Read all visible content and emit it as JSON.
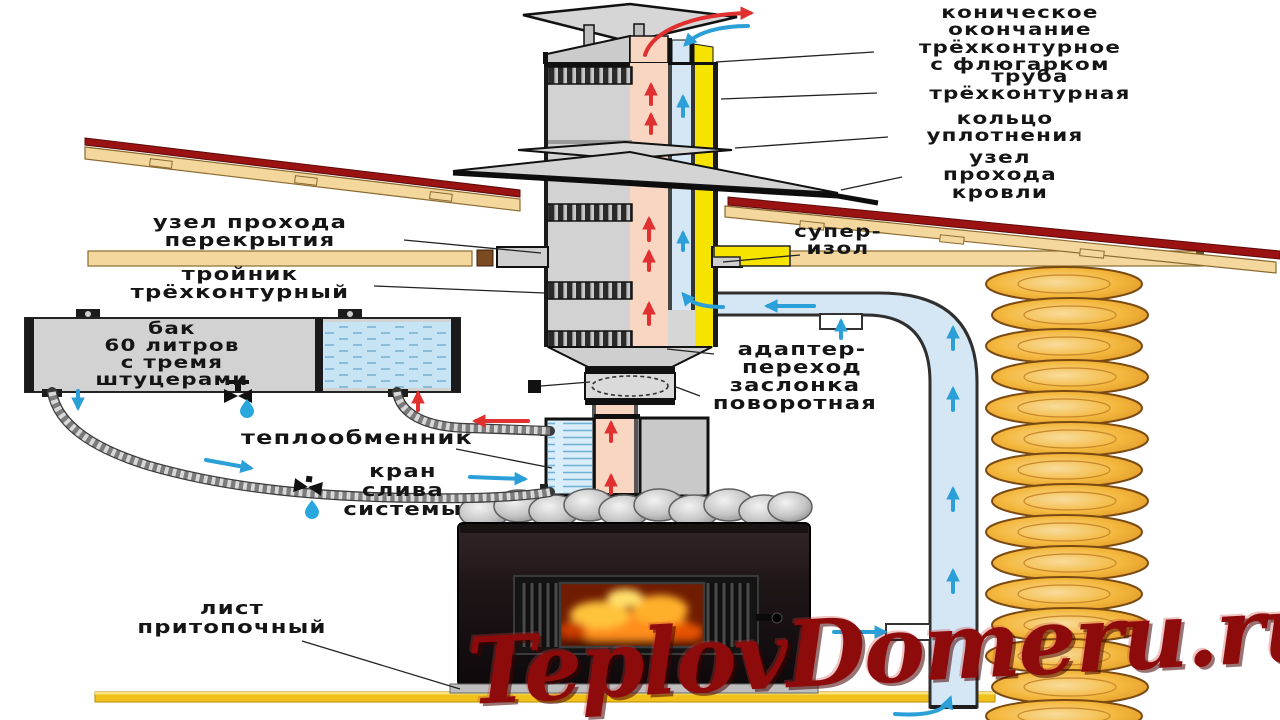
{
  "diagram": {
    "subject": "Схема монтажа банной печи с трёхконтурным дымоходом",
    "labels": {
      "cap": "коническое\nокончание\nтрёхконтурное\nс флюгарком",
      "pipe": "труба\nтрёхконтурная",
      "ring": "кольцо\nуплотнения",
      "roof_pass": "узел\nпрохода\nкровли",
      "super_isol": "супер-\nизол",
      "ceiling_pass": "узел прохода\nперекрытия",
      "tee": "тройник\nтрёхконтурный",
      "tank": "бак\n60 литров\nс тремя\nштуцерами",
      "adapter": "адаптер-\nпереход",
      "damper": "заслонка\nповоротная",
      "heat_exchanger": "теплообменник",
      "drain_valve": "кран\nслива\nсистемы",
      "hearth_sheet": "лист\nпритопочный"
    },
    "icons": {
      "up_red_arrow": "hot flue gases flow",
      "up_blue_arrow": "fresh air flow",
      "drop": "water drop",
      "valve": "tap valve"
    }
  },
  "watermark": {
    "text": "TeplovDomeru.ru"
  },
  "colors": {
    "flue_pink": "#f9d6c2",
    "air_blue": "#d5e6f5",
    "insulation_yellow": "#f6e400",
    "casing_gray": "#d2d2d2",
    "wood_tan": "#f3d79c",
    "roof_red": "#9b1212",
    "water_blue": "#c6e4f4",
    "arrow_red": "#e03030",
    "arrow_blue": "#2b9fd8",
    "log_orange": "#f4b83e",
    "hearth_yellow": "#f2c21c",
    "watermark_red": "#8e0b0b",
    "label_ink": "#151515"
  }
}
